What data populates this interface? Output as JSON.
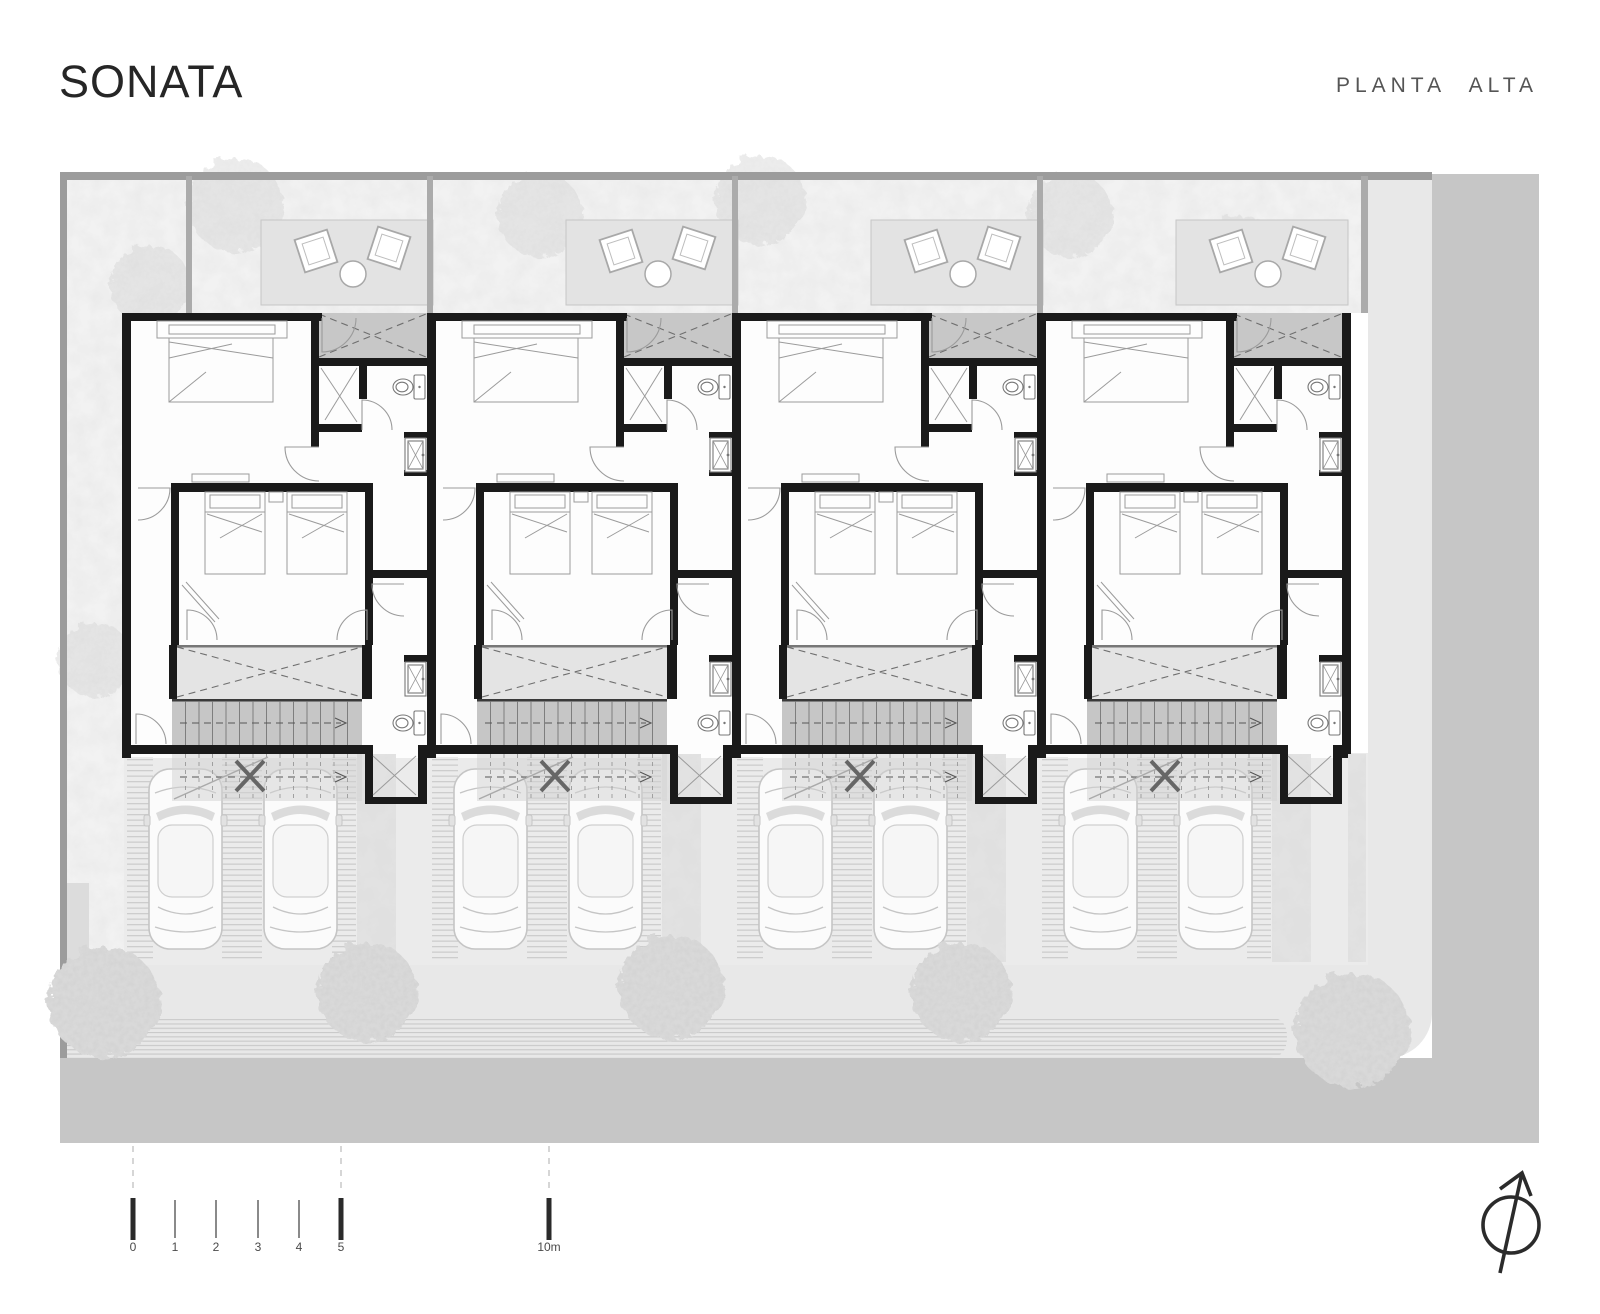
{
  "header": {
    "title": "SONATA",
    "plan_label": "PLANTA ALTA"
  },
  "scale_bar": {
    "labels": [
      "0",
      "1",
      "2",
      "3",
      "4",
      "5",
      "10m"
    ]
  },
  "icons": {
    "north_arrow": "north-arrow-icon"
  },
  "colors": {
    "wall": "#1a1a1a",
    "street": "#c6c6c6",
    "sidewalk": "#e8e8e8",
    "terrace": "#e3e3e3",
    "void_hatch": "#c7c7c7",
    "stair": "#c6c6c6",
    "paving": "#ebebeb",
    "border": "#9c9c9c",
    "title_color": "#262626",
    "subtitle_color": "#555555"
  }
}
